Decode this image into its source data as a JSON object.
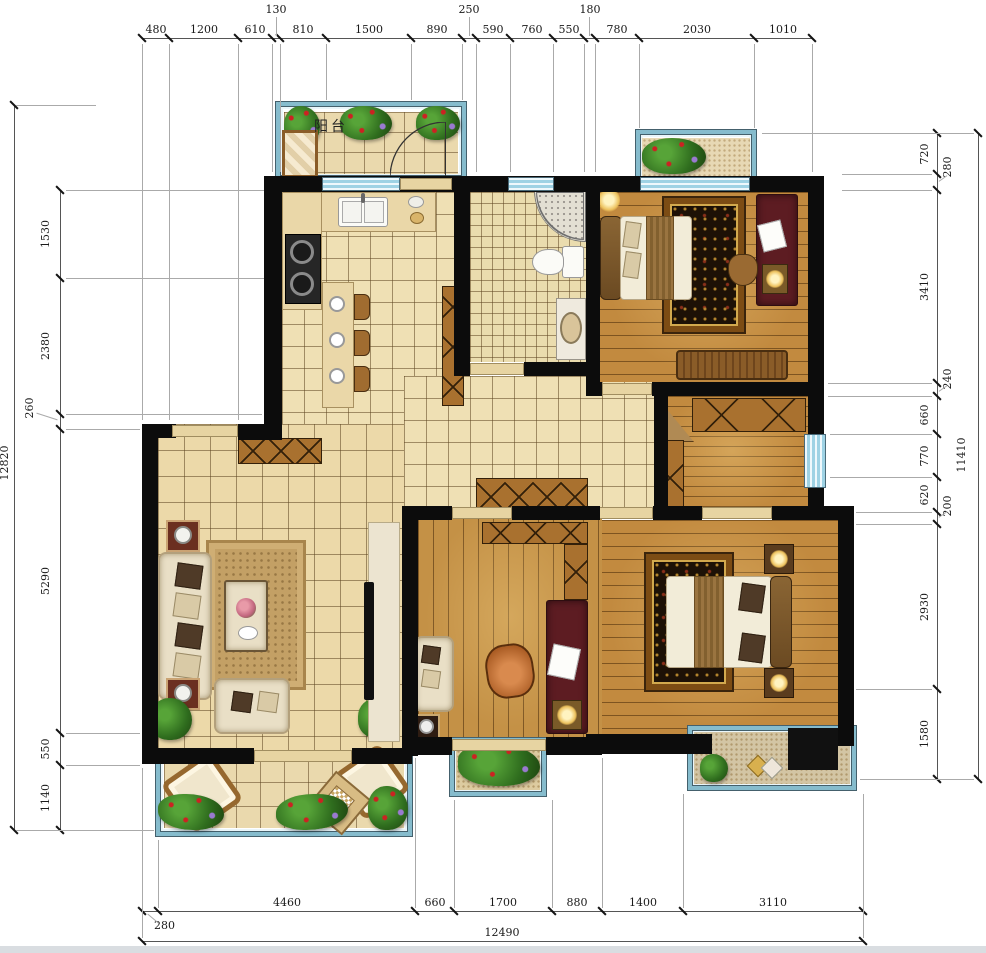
{
  "labels": {
    "balcony_top": "阳台"
  },
  "dims": {
    "top": [
      "480",
      "1200",
      "610",
      "130",
      "810",
      "1500",
      "890",
      "250",
      "590",
      "760",
      "550",
      "180",
      "780",
      "2030",
      "1010"
    ],
    "left": [
      "1530",
      "2380",
      "260",
      "5290",
      "550",
      "1140"
    ],
    "left_overall": "12820",
    "right": [
      "720",
      "280",
      "3410",
      "240",
      "660",
      "770",
      "620",
      "200",
      "2930",
      "1580"
    ],
    "right_overall": "11410",
    "bottom": [
      "280",
      "4460",
      "660",
      "1700",
      "880",
      "1400",
      "3110"
    ],
    "bottom_overall": "12490"
  },
  "colors": {
    "wall": "#0c0c0c",
    "window_blue": "#9ed2e4",
    "tile_floor": "#ecd9a9",
    "wood_floor": "#c28a3f",
    "balcony_frame": "#86bccd",
    "desk_red": "#5d1c22"
  }
}
